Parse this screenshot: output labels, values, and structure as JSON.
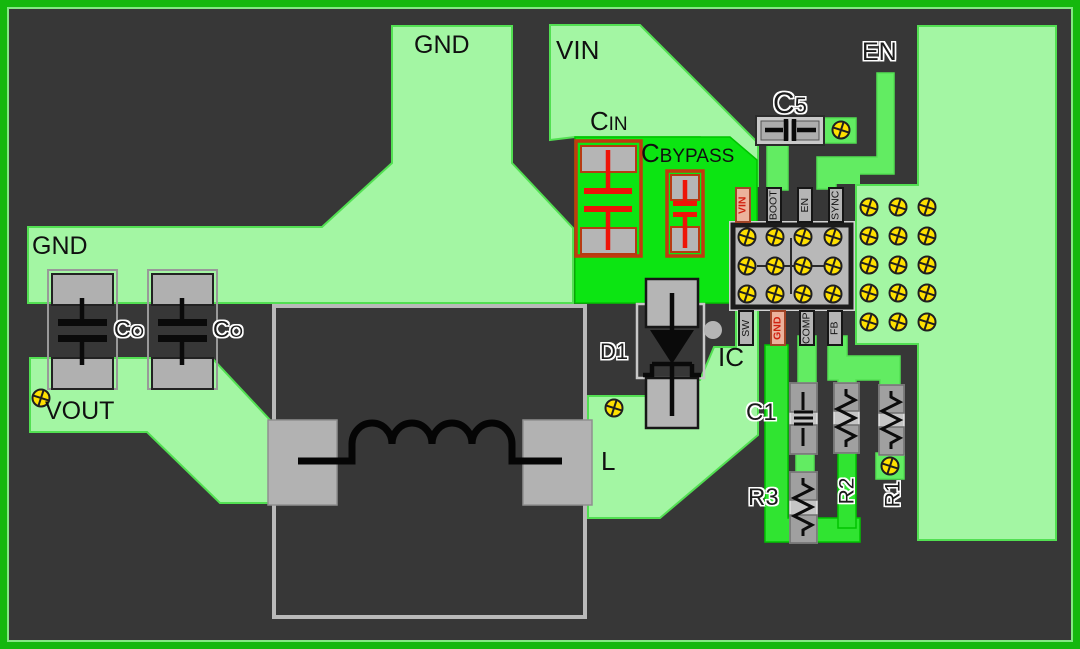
{
  "diagram": {
    "type": "pcb-layout",
    "description": "Buck converter PCB layout diagram with IC, input capacitors, catch diode, inductor and feedback network"
  },
  "colors": {
    "board_bg": "#373737",
    "board_border": "#15b80e",
    "copper_light": "#a3f6a3",
    "copper_bright": "#0ce512",
    "trace_green": "#62ec62",
    "gnd_trace": "#30e431",
    "copper_edge": "#52e052",
    "bright_edge": "#00c400",
    "pad_gray": "#b5b5b5",
    "pad_border": "#161616",
    "pin_pink": "#ecb29c",
    "pin_pink_border": "#a34527",
    "pin_pink_text": "#d1200f",
    "red_outline": "#c23a10",
    "red_symbol": "#ee1408",
    "via_yellow": "#ffe000",
    "silkscreen": "#0a0a0a",
    "label_text": "#101010"
  },
  "labels": {
    "gnd_top": "GND",
    "gnd_plane": "GND",
    "vin_plane": "VIN",
    "cin": "CIN",
    "cbypass": "CBYPASS",
    "c5": "C5",
    "en": "EN",
    "co_a": "CO",
    "co_b": "CO",
    "vout": "VOUT",
    "d1": "D1",
    "ic": "IC",
    "inductor": "L",
    "c1": "C1",
    "r3": "R3",
    "r2": "R2",
    "r1": "R1"
  },
  "ic": {
    "pins_top": [
      "VIN",
      "BOOT",
      "EN",
      "SYNC"
    ],
    "pins_bottom": [
      "SW",
      "GND",
      "COMP",
      "FB"
    ],
    "thermal_vias": {
      "cols": 4,
      "rows": 3
    }
  },
  "via_grids": {
    "gnd_plane_right": {
      "cols": 3,
      "rows": 5
    }
  }
}
